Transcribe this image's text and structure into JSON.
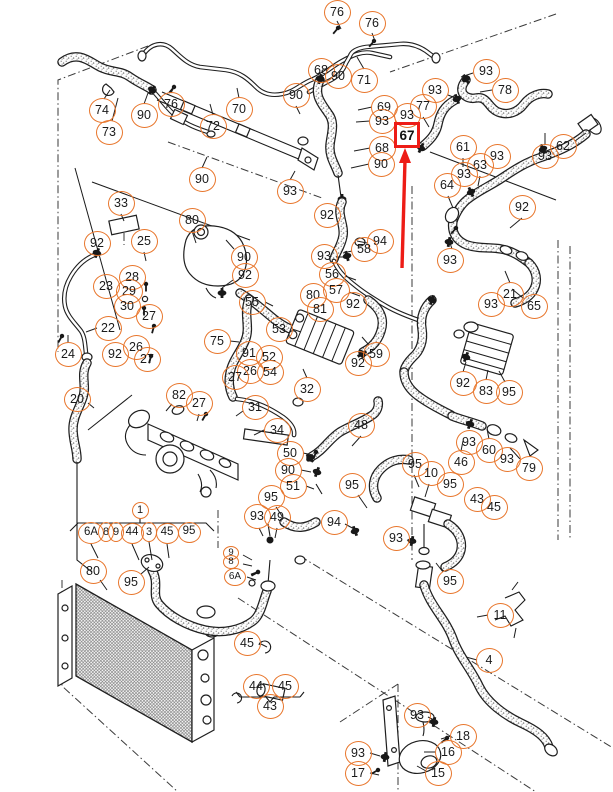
{
  "figure": {
    "kind": "exploded parts diagram",
    "subject": "Engine cooling system — hoses, pipes, radiator, expansion tank",
    "background": "#ffffff"
  },
  "colors": {
    "callout_ring": "#E8762C",
    "line_art": "#1f1f1f",
    "highlight_red": "#ED1C16"
  },
  "highlight": {
    "part_number": "67",
    "style": "red box with red arrow pointing up at it"
  },
  "callouts": [
    [
      "74",
      102,
      110
    ],
    [
      "73",
      109,
      132
    ],
    [
      "90",
      144,
      115
    ],
    [
      "76",
      171,
      104
    ],
    [
      "70",
      239,
      109
    ],
    [
      "72",
      213,
      126
    ],
    [
      "90",
      202,
      179
    ],
    [
      "90",
      296,
      95
    ],
    [
      "93",
      290,
      191
    ],
    [
      "76",
      337,
      12
    ],
    [
      "76",
      372,
      23
    ],
    [
      "68",
      321,
      70
    ],
    [
      "90",
      338,
      76
    ],
    [
      "71",
      364,
      80
    ],
    [
      "93",
      435,
      90
    ],
    [
      "77",
      423,
      106
    ],
    [
      "69",
      384,
      107
    ],
    [
      "93",
      407,
      115
    ],
    [
      "93",
      382,
      121
    ],
    [
      "68",
      382,
      148
    ],
    [
      "90",
      381,
      164
    ],
    [
      "93",
      486,
      71
    ],
    [
      "78",
      505,
      90
    ],
    [
      "61",
      463,
      147
    ],
    [
      "93",
      497,
      156
    ],
    [
      "63",
      480,
      165
    ],
    [
      "93",
      464,
      174
    ],
    [
      "64",
      447,
      185
    ],
    [
      "93",
      545,
      156
    ],
    [
      "62",
      563,
      146
    ],
    [
      "33",
      121,
      203
    ],
    [
      "92",
      97,
      243
    ],
    [
      "25",
      144,
      241
    ],
    [
      "80",
      192,
      220
    ],
    [
      "90",
      244,
      257
    ],
    [
      "92",
      245,
      275
    ],
    [
      "28",
      132,
      277
    ],
    [
      "23",
      106,
      286
    ],
    [
      "29",
      129,
      291
    ],
    [
      "30",
      127,
      306
    ],
    [
      "27",
      149,
      316
    ],
    [
      "22",
      108,
      328
    ],
    [
      "26",
      136,
      347
    ],
    [
      "92",
      115,
      354
    ],
    [
      "27",
      147,
      359
    ],
    [
      "24",
      68,
      354
    ],
    [
      "20",
      77,
      399
    ],
    [
      "55",
      252,
      302
    ],
    [
      "53",
      279,
      329
    ],
    [
      "75",
      217,
      341
    ],
    [
      "91",
      249,
      353
    ],
    [
      "52",
      269,
      357
    ],
    [
      "26",
      250,
      371
    ],
    [
      "54",
      270,
      372
    ],
    [
      "27",
      235,
      377
    ],
    [
      "32",
      307,
      389
    ],
    [
      "92",
      327,
      215
    ],
    [
      "94",
      380,
      241
    ],
    [
      "58",
      364,
      249
    ],
    [
      "93",
      324,
      256
    ],
    [
      "56",
      332,
      274
    ],
    [
      "57",
      336,
      290
    ],
    [
      "80",
      313,
      295
    ],
    [
      "81",
      320,
      309
    ],
    [
      "92",
      353,
      304
    ],
    [
      "59",
      376,
      354
    ],
    [
      "92",
      358,
      363
    ],
    [
      "92",
      522,
      207
    ],
    [
      "93",
      450,
      260
    ],
    [
      "21",
      510,
      294
    ],
    [
      "93",
      491,
      304
    ],
    [
      "65",
      534,
      306
    ],
    [
      "92",
      463,
      383
    ],
    [
      "83",
      486,
      391
    ],
    [
      "95",
      509,
      392
    ],
    [
      "82",
      179,
      395
    ],
    [
      "27",
      199,
      403
    ],
    [
      "31",
      255,
      407
    ],
    [
      "34",
      277,
      430
    ],
    [
      "50",
      290,
      453
    ],
    [
      "90",
      288,
      470
    ],
    [
      "51",
      293,
      486
    ],
    [
      "95",
      271,
      497
    ],
    [
      "93",
      257,
      516
    ],
    [
      "49",
      277,
      517
    ],
    [
      "1",
      140,
      510,
      17,
      17,
      11
    ],
    [
      "6A",
      91,
      533,
      26,
      22,
      11.5
    ],
    [
      "8",
      106,
      532,
      16,
      20,
      11
    ],
    [
      "9",
      116,
      532,
      16,
      20,
      11
    ],
    [
      "44",
      132,
      533,
      23,
      21,
      11.5
    ],
    [
      "3",
      149,
      532,
      16,
      20,
      11
    ],
    [
      "45",
      167,
      533,
      23,
      21,
      11.5
    ],
    [
      "95",
      189,
      532,
      23,
      21,
      11.5
    ],
    [
      "80",
      93,
      571
    ],
    [
      "95",
      131,
      582
    ],
    [
      "9",
      231,
      553,
      16,
      14,
      9.5
    ],
    [
      "8",
      231,
      562,
      16,
      14,
      9.5
    ],
    [
      "6A",
      235,
      577,
      22,
      18,
      10
    ],
    [
      "48",
      361,
      425
    ],
    [
      "93",
      469,
      442
    ],
    [
      "60",
      489,
      450
    ],
    [
      "93",
      507,
      459
    ],
    [
      "46",
      461,
      462
    ],
    [
      "79",
      529,
      468
    ],
    [
      "95",
      415,
      464
    ],
    [
      "10",
      431,
      473
    ],
    [
      "95",
      450,
      484
    ],
    [
      "95",
      352,
      485
    ],
    [
      "43",
      477,
      499
    ],
    [
      "45",
      494,
      507
    ],
    [
      "94",
      334,
      522
    ],
    [
      "93",
      396,
      538
    ],
    [
      "95",
      450,
      581
    ],
    [
      "45",
      247,
      643
    ],
    [
      "44",
      256,
      686
    ],
    [
      "45",
      285,
      686
    ],
    [
      "43",
      270,
      706
    ],
    [
      "11",
      500,
      615
    ],
    [
      "4",
      489,
      660
    ],
    [
      "93",
      417,
      715
    ],
    [
      "18",
      463,
      736
    ],
    [
      "16",
      448,
      752
    ],
    [
      "93",
      358,
      753
    ],
    [
      "17",
      358,
      773
    ],
    [
      "15",
      438,
      773
    ]
  ]
}
